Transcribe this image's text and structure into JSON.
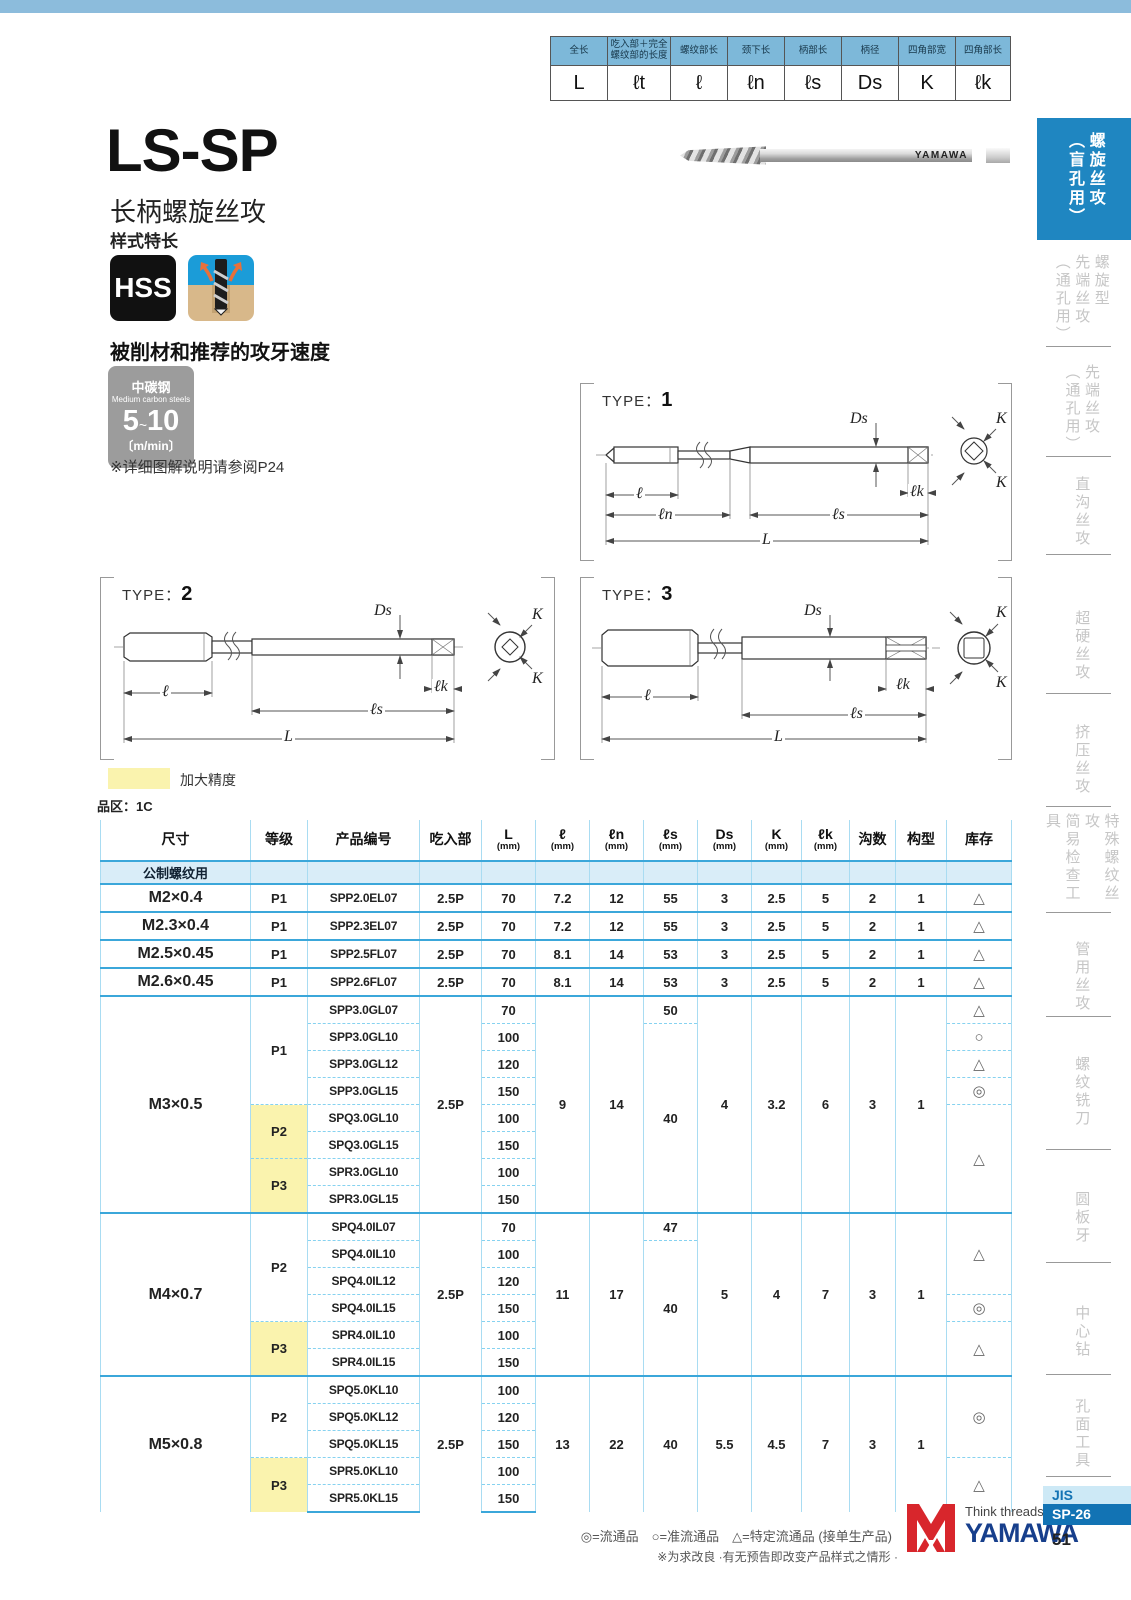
{
  "dim_legend": {
    "columns": [
      {
        "cn": "全长",
        "sym": "L"
      },
      {
        "cn": "吃入部＋完全螺纹部的长度",
        "sym": "ℓt"
      },
      {
        "cn": "螺纹部长",
        "sym": "ℓ"
      },
      {
        "cn": "颈下长",
        "sym": "ℓn"
      },
      {
        "cn": "柄部长",
        "sym": "ℓs"
      },
      {
        "cn": "柄径",
        "sym": "Ds"
      },
      {
        "cn": "四角部宽",
        "sym": "K"
      },
      {
        "cn": "四角部长",
        "sym": "ℓk"
      }
    ]
  },
  "header": {
    "title": "LS-SP",
    "subtitle": "长柄螺旋丝攻",
    "style_note": "样式特长",
    "hss": "HSS",
    "photo_brand": "YAMAWA"
  },
  "speed": {
    "heading": "被削材和推荐的攻牙速度",
    "material_cn": "中碳钢",
    "material_en": "Medium carbon steels",
    "range_low": "5",
    "tilde": "~",
    "range_high": "10",
    "unit": "〔m/min〕",
    "note": "※详细图解说明请参阅P24"
  },
  "diagrams": {
    "type_label": "TYPE：",
    "types": [
      "1",
      "2",
      "3"
    ],
    "labels": {
      "ds": "Ds",
      "l": "ℓ",
      "ln": "ℓn",
      "ls": "ℓs",
      "lk": "ℓk",
      "total": "L",
      "k": "K"
    }
  },
  "legend": {
    "yellow_label": "加大精度",
    "series_label": "品区：1C"
  },
  "table": {
    "columns": [
      {
        "label": "尺寸"
      },
      {
        "label": "等级"
      },
      {
        "label": "产品编号"
      },
      {
        "label": "吃入部"
      },
      {
        "label": "L",
        "sub": "(mm)"
      },
      {
        "label": "ℓ",
        "sub": "(mm)"
      },
      {
        "label": "ℓn",
        "sub": "(mm)"
      },
      {
        "label": "ℓs",
        "sub": "(mm)"
      },
      {
        "label": "Ds",
        "sub": "(mm)"
      },
      {
        "label": "K",
        "sub": "(mm)"
      },
      {
        "label": "ℓk",
        "sub": "(mm)"
      },
      {
        "label": "沟数"
      },
      {
        "label": "构型"
      },
      {
        "label": "库存"
      }
    ],
    "sections": [
      {
        "cls": "group-row",
        "rows": [
          [
            {
              "t": "公制螺纹用",
              "cls": "group-label"
            },
            {},
            {},
            {},
            {},
            {},
            {},
            {},
            {},
            {},
            {},
            {},
            {},
            {}
          ]
        ]
      },
      {
        "rows": [
          [
            {
              "t": "M2×0.4",
              "cls": "size"
            },
            {
              "t": "P1",
              "cls": "grade"
            },
            {
              "t": "SPP2.0EL07",
              "cls": "prod"
            },
            {
              "t": "2.5P"
            },
            {
              "t": "70"
            },
            {
              "t": "7.2"
            },
            {
              "t": "12"
            },
            {
              "t": "55"
            },
            {
              "t": "3"
            },
            {
              "t": "2.5"
            },
            {
              "t": "5"
            },
            {
              "t": "2"
            },
            {
              "t": "1"
            },
            {
              "t": "△",
              "cls": "stock"
            }
          ]
        ]
      },
      {
        "rows": [
          [
            {
              "t": "M2.3×0.4",
              "cls": "size"
            },
            {
              "t": "P1",
              "cls": "grade"
            },
            {
              "t": "SPP2.3EL07",
              "cls": "prod"
            },
            {
              "t": "2.5P"
            },
            {
              "t": "70"
            },
            {
              "t": "7.2"
            },
            {
              "t": "12"
            },
            {
              "t": "55"
            },
            {
              "t": "3"
            },
            {
              "t": "2.5"
            },
            {
              "t": "5"
            },
            {
              "t": "2"
            },
            {
              "t": "1"
            },
            {
              "t": "△",
              "cls": "stock"
            }
          ]
        ]
      },
      {
        "rows": [
          [
            {
              "t": "M2.5×0.45",
              "cls": "size"
            },
            {
              "t": "P1",
              "cls": "grade"
            },
            {
              "t": "SPP2.5FL07",
              "cls": "prod"
            },
            {
              "t": "2.5P"
            },
            {
              "t": "70"
            },
            {
              "t": "8.1"
            },
            {
              "t": "14"
            },
            {
              "t": "53"
            },
            {
              "t": "3"
            },
            {
              "t": "2.5"
            },
            {
              "t": "5"
            },
            {
              "t": "2"
            },
            {
              "t": "1"
            },
            {
              "t": "△",
              "cls": "stock"
            }
          ]
        ]
      },
      {
        "rows": [
          [
            {
              "t": "M2.6×0.45",
              "cls": "size"
            },
            {
              "t": "P1",
              "cls": "grade"
            },
            {
              "t": "SPP2.6FL07",
              "cls": "prod"
            },
            {
              "t": "2.5P"
            },
            {
              "t": "70"
            },
            {
              "t": "8.1"
            },
            {
              "t": "14"
            },
            {
              "t": "53"
            },
            {
              "t": "3"
            },
            {
              "t": "2.5"
            },
            {
              "t": "5"
            },
            {
              "t": "2"
            },
            {
              "t": "1"
            },
            {
              "t": "△",
              "cls": "stock"
            }
          ]
        ]
      },
      {
        "rows": [
          [
            {
              "t": "M3×0.5",
              "cls": "size",
              "rs": 8
            },
            {
              "t": "P1",
              "cls": "grade",
              "rs": 4
            },
            {
              "t": "SPP3.0GL07",
              "cls": "prod"
            },
            {
              "t": "2.5P",
              "rs": 8
            },
            {
              "t": "70"
            },
            {
              "t": "9",
              "rs": 8
            },
            {
              "t": "14",
              "rs": 8
            },
            {
              "t": "50"
            },
            {
              "t": "4",
              "rs": 8
            },
            {
              "t": "3.2",
              "rs": 8
            },
            {
              "t": "6",
              "rs": 8
            },
            {
              "t": "3",
              "rs": 8
            },
            {
              "t": "1",
              "rs": 8
            },
            {
              "t": "△",
              "cls": "stock"
            }
          ],
          [
            {
              "t": "SPP3.0GL10",
              "cls": "prod"
            },
            {
              "t": "100"
            },
            {
              "t": "40",
              "rs": 7
            },
            {
              "t": "○",
              "cls": "stock"
            }
          ],
          [
            {
              "t": "SPP3.0GL12",
              "cls": "prod"
            },
            {
              "t": "120"
            },
            {
              "t": "△",
              "cls": "stock"
            }
          ],
          [
            {
              "t": "SPP3.0GL15",
              "cls": "prod"
            },
            {
              "t": "150"
            },
            {
              "t": "◎",
              "cls": "stock"
            }
          ],
          [
            {
              "t": "P2",
              "cls": "grade yellow",
              "rs": 2
            },
            {
              "t": "SPQ3.0GL10",
              "cls": "prod"
            },
            {
              "t": "100"
            },
            {
              "t": "△",
              "cls": "stock",
              "rs": 4
            }
          ],
          [
            {
              "t": "SPQ3.0GL15",
              "cls": "prod"
            },
            {
              "t": "150"
            }
          ],
          [
            {
              "t": "P3",
              "cls": "grade yellow",
              "rs": 2
            },
            {
              "t": "SPR3.0GL10",
              "cls": "prod"
            },
            {
              "t": "100"
            }
          ],
          [
            {
              "t": "SPR3.0GL15",
              "cls": "prod"
            },
            {
              "t": "150"
            }
          ]
        ]
      },
      {
        "rows": [
          [
            {
              "t": "M4×0.7",
              "cls": "size",
              "rs": 6
            },
            {
              "t": "P2",
              "cls": "grade",
              "rs": 4
            },
            {
              "t": "SPQ4.0IL07",
              "cls": "prod"
            },
            {
              "t": "2.5P",
              "rs": 6
            },
            {
              "t": "70"
            },
            {
              "t": "11",
              "rs": 6
            },
            {
              "t": "17",
              "rs": 6
            },
            {
              "t": "47"
            },
            {
              "t": "5",
              "rs": 6
            },
            {
              "t": "4",
              "rs": 6
            },
            {
              "t": "7",
              "rs": 6
            },
            {
              "t": "3",
              "rs": 6
            },
            {
              "t": "1",
              "rs": 6
            },
            {
              "t": "△",
              "cls": "stock",
              "rs": 3
            }
          ],
          [
            {
              "t": "SPQ4.0IL10",
              "cls": "prod"
            },
            {
              "t": "100"
            },
            {
              "t": "40",
              "rs": 5
            }
          ],
          [
            {
              "t": "SPQ4.0IL12",
              "cls": "prod"
            },
            {
              "t": "120"
            }
          ],
          [
            {
              "t": "SPQ4.0IL15",
              "cls": "prod"
            },
            {
              "t": "150"
            },
            {
              "t": "◎",
              "cls": "stock"
            }
          ],
          [
            {
              "t": "P3",
              "cls": "grade yellow",
              "rs": 2
            },
            {
              "t": "SPR4.0IL10",
              "cls": "prod"
            },
            {
              "t": "100"
            },
            {
              "t": "△",
              "cls": "stock",
              "rs": 2
            }
          ],
          [
            {
              "t": "SPR4.0IL15",
              "cls": "prod"
            },
            {
              "t": "150"
            }
          ]
        ]
      },
      {
        "rows": [
          [
            {
              "t": "M5×0.8",
              "cls": "size",
              "rs": 5
            },
            {
              "t": "P2",
              "cls": "grade",
              "rs": 3
            },
            {
              "t": "SPQ5.0KL10",
              "cls": "prod"
            },
            {
              "t": "2.5P",
              "rs": 5
            },
            {
              "t": "100"
            },
            {
              "t": "13",
              "rs": 5
            },
            {
              "t": "22",
              "rs": 5
            },
            {
              "t": "40",
              "rs": 5
            },
            {
              "t": "5.5",
              "rs": 5
            },
            {
              "t": "4.5",
              "rs": 5
            },
            {
              "t": "7",
              "rs": 5
            },
            {
              "t": "3",
              "rs": 5
            },
            {
              "t": "1",
              "rs": 5
            },
            {
              "t": "◎",
              "cls": "stock",
              "rs": 3
            }
          ],
          [
            {
              "t": "SPQ5.0KL12",
              "cls": "prod"
            },
            {
              "t": "120"
            }
          ],
          [
            {
              "t": "SPQ5.0KL15",
              "cls": "prod"
            },
            {
              "t": "150"
            }
          ],
          [
            {
              "t": "P3",
              "cls": "grade yellow",
              "rs": 2
            },
            {
              "t": "SPR5.0KL10",
              "cls": "prod"
            },
            {
              "t": "100"
            },
            {
              "t": "△",
              "cls": "stock",
              "rs": 2
            }
          ],
          [
            {
              "t": "SPR5.0KL15",
              "cls": "prod"
            },
            {
              "t": "150"
            }
          ]
        ]
      }
    ]
  },
  "sidebar": {
    "items": [
      {
        "label": "螺旋丝攻\n（盲孔用）",
        "active": true
      },
      {
        "label": "螺旋型\n先端丝攻\n（通孔用）"
      },
      {
        "label": "先端丝攻\n（通孔用）"
      },
      {
        "label": "直沟丝攻"
      },
      {
        "label": "超硬丝攻"
      },
      {
        "label": "挤压丝攻"
      },
      {
        "label": "特殊螺纹丝攻\n简易检查工具"
      },
      {
        "label": "管用丝攻"
      },
      {
        "label": "螺纹铣刀"
      },
      {
        "label": "圆板牙"
      },
      {
        "label": "中心钻"
      },
      {
        "label": "孔面工具"
      }
    ],
    "jis": "JIS",
    "code": "SP-26",
    "page": "51"
  },
  "footer": {
    "stock_legend": "◎=流通品　○=准流通品　△=特定流通品 (接单生产品)",
    "note": "※为求改良 ·有无预告即改变产品样式之情形 ·",
    "brand_tagline": "Think threads with",
    "brand": "YAMAWA"
  }
}
